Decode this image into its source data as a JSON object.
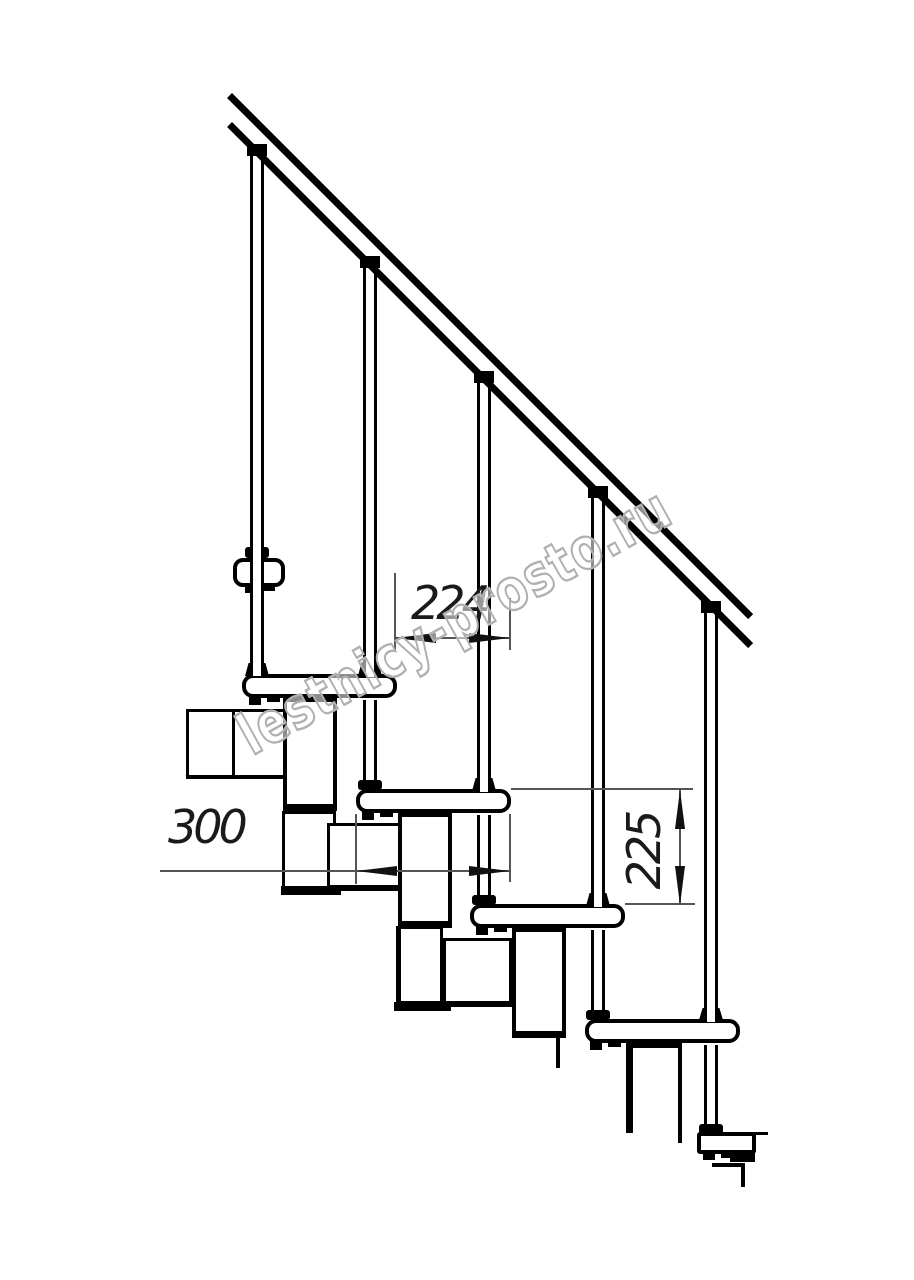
{
  "drawing": {
    "type": "modular staircase side-view technical drawing",
    "watermark": "lestnicy-prosto.ru",
    "dimensions": {
      "step_run": "224",
      "tread_depth": "300",
      "step_rise": "225"
    }
  }
}
